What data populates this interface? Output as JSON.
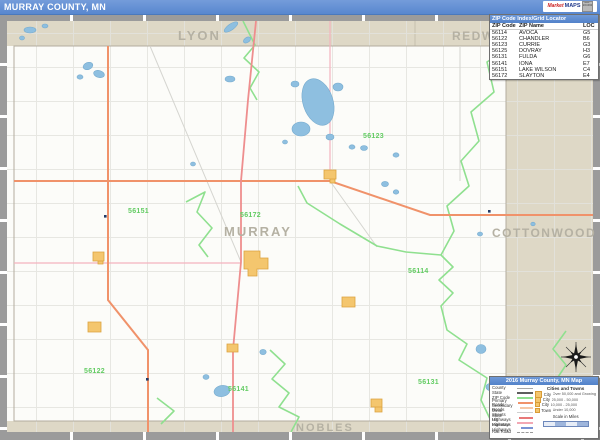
{
  "title_bar": {
    "title": "MURRAY COUNTY, MN",
    "logo_market": "Market",
    "logo_maps": "MAPS",
    "logo_badge": "MAP SOURCE"
  },
  "zip_table": {
    "header": "ZIP Code Index/Grid Locator",
    "columns": [
      "ZIP Code",
      "ZIP Name",
      "LOC"
    ],
    "rows": [
      [
        "56114",
        "AVOCA",
        "G5"
      ],
      [
        "56122",
        "CHANDLER",
        "B6"
      ],
      [
        "56123",
        "CURRIE",
        "G3"
      ],
      [
        "56125",
        "DOVRAY",
        "H3"
      ],
      [
        "56131",
        "FULDA",
        "G6"
      ],
      [
        "56141",
        "IONA",
        "E7"
      ],
      [
        "56151",
        "LAKE WILSON",
        "C4"
      ],
      [
        "56172",
        "SLAYTON",
        "E4"
      ]
    ]
  },
  "map": {
    "county_labels": [
      {
        "text": "LYON"
      },
      {
        "text": "REDWOOD"
      },
      {
        "text": "MURRAY"
      },
      {
        "text": "COTTONWOOD"
      },
      {
        "text": "NOBLES"
      }
    ],
    "zip_labels": [
      {
        "text": "56151"
      },
      {
        "text": "56172"
      },
      {
        "text": "56123"
      },
      {
        "text": "56114"
      },
      {
        "text": "56122"
      },
      {
        "text": "56141"
      },
      {
        "text": "56131"
      }
    ]
  },
  "legend": {
    "header": "2016 Murray County, MN Map",
    "line_items": [
      {
        "label": "County"
      },
      {
        "label": "State"
      },
      {
        "label": "ZIP Code"
      },
      {
        "label": "Primary Roads"
      },
      {
        "label": "Secondary Roads"
      },
      {
        "label": "Minor Streets"
      },
      {
        "label": "State Highways"
      },
      {
        "label": "US Highways"
      },
      {
        "label": "Interstate Highways"
      },
      {
        "label": "Rail Road"
      }
    ],
    "cities_header": "Cities and Towns",
    "city_items": [
      {
        "label": "City",
        "range": "Over 50,000 and Growing"
      },
      {
        "label": "City",
        "range": "25,000 - 50,000"
      },
      {
        "label": "City",
        "range": "10,000 - 25,000"
      },
      {
        "label": "Town",
        "range": "Under 10,000"
      }
    ],
    "scale_label": "Scale in Miles"
  },
  "colors": {
    "titlebar_blue": "#6190d4",
    "neighbor_band_tan": "#ded8c6",
    "county_label_gray": "#b5b1a3",
    "zip_label_green": "#63cc63",
    "zip_boundary_green": "#8fe08f",
    "lake_blue": "#8ebfe0",
    "city_yellow": "#f4c66e",
    "road_orange": "#f0926a",
    "road_pink": "#ee8e8e",
    "frame_gray": "#9b9b9b"
  }
}
